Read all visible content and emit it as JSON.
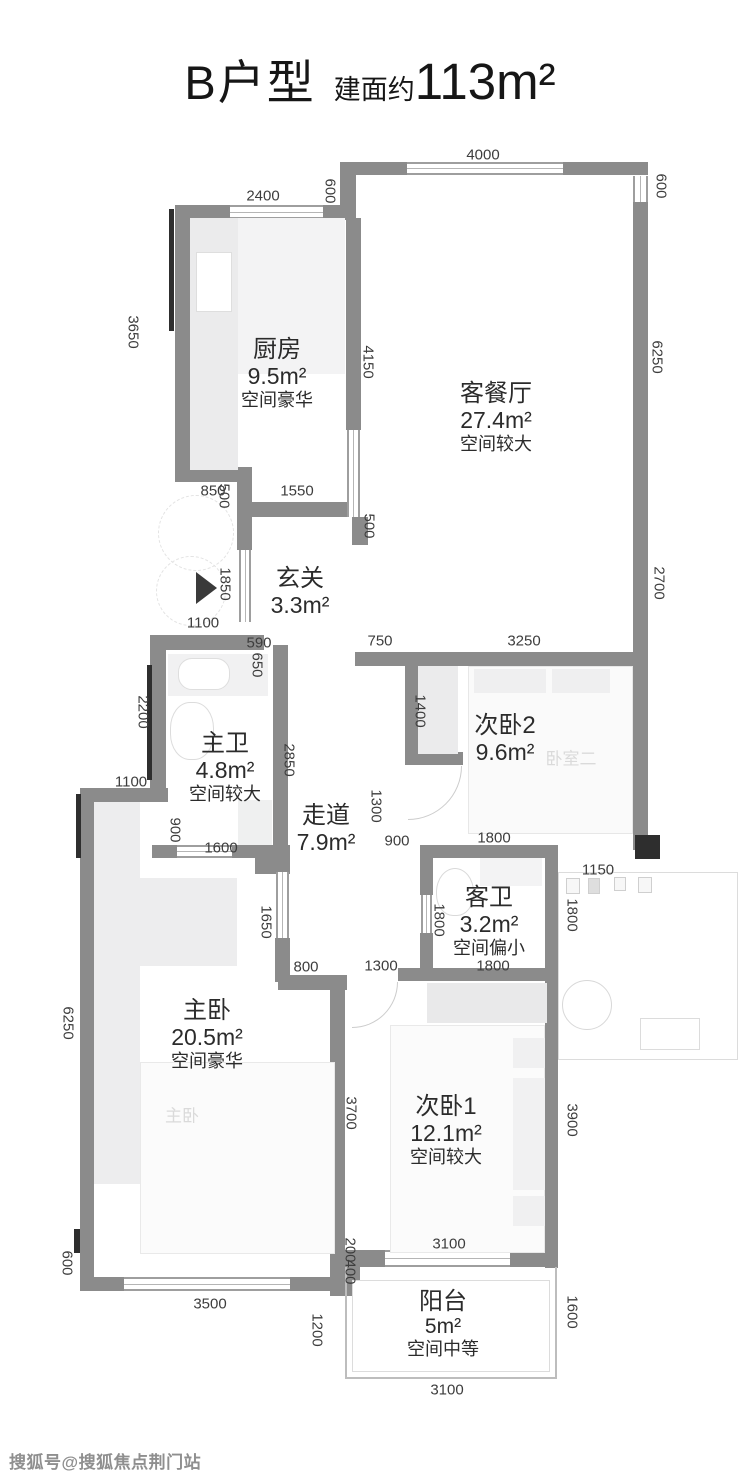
{
  "title": {
    "type_name": "B户型",
    "area_prefix": "建面约",
    "area_value": "113m²"
  },
  "rooms": [
    {
      "id": "kitchen",
      "name": "厨房",
      "area": "9.5m²",
      "note": "空间豪华"
    },
    {
      "id": "living-dining",
      "name": "客餐厅",
      "area": "27.4m²",
      "note": "空间较大"
    },
    {
      "id": "foyer",
      "name": "玄关",
      "area": "3.3m²",
      "note": ""
    },
    {
      "id": "master-bath",
      "name": "主卫",
      "area": "4.8m²",
      "note": "空间较大"
    },
    {
      "id": "corridor",
      "name": "走道",
      "area": "7.9m²",
      "note": ""
    },
    {
      "id": "bedroom-2",
      "name": "次卧2",
      "area": "9.6m²",
      "note": ""
    },
    {
      "id": "guest-bath",
      "name": "客卫",
      "area": "3.2m²",
      "note": "空间偏小"
    },
    {
      "id": "master-bedroom",
      "name": "主卧",
      "area": "20.5m²",
      "note": "空间豪华"
    },
    {
      "id": "bedroom-1",
      "name": "次卧1",
      "area": "12.1m²",
      "note": "空间较大"
    },
    {
      "id": "balcony",
      "name": "阳台",
      "area": "5m²",
      "note": "空间中等"
    }
  ],
  "dims": [
    "4000",
    "2400",
    "600",
    "600",
    "3650",
    "4150",
    "1550",
    "850",
    "500",
    "500",
    "1850",
    "1100",
    "590",
    "650",
    "750",
    "3250",
    "6250",
    "2700",
    "2200",
    "2850",
    "1400",
    "1300",
    "900",
    "1800",
    "1100",
    "900",
    "1600",
    "1150",
    "1800",
    "1800",
    "1800",
    "1650",
    "800",
    "1300",
    "6250",
    "3700",
    "3900",
    "600",
    "3500",
    "200",
    "400",
    "1200",
    "3100",
    "1600",
    "3100"
  ],
  "ghost_labels": [
    "卧室二",
    "主卧"
  ],
  "watermark": "搜狐号@搜狐焦点荆门站",
  "colors": {
    "wall": "#8b8b8b",
    "dim_text": "#3d3d3d",
    "marker_black": "#2e2e2e"
  }
}
